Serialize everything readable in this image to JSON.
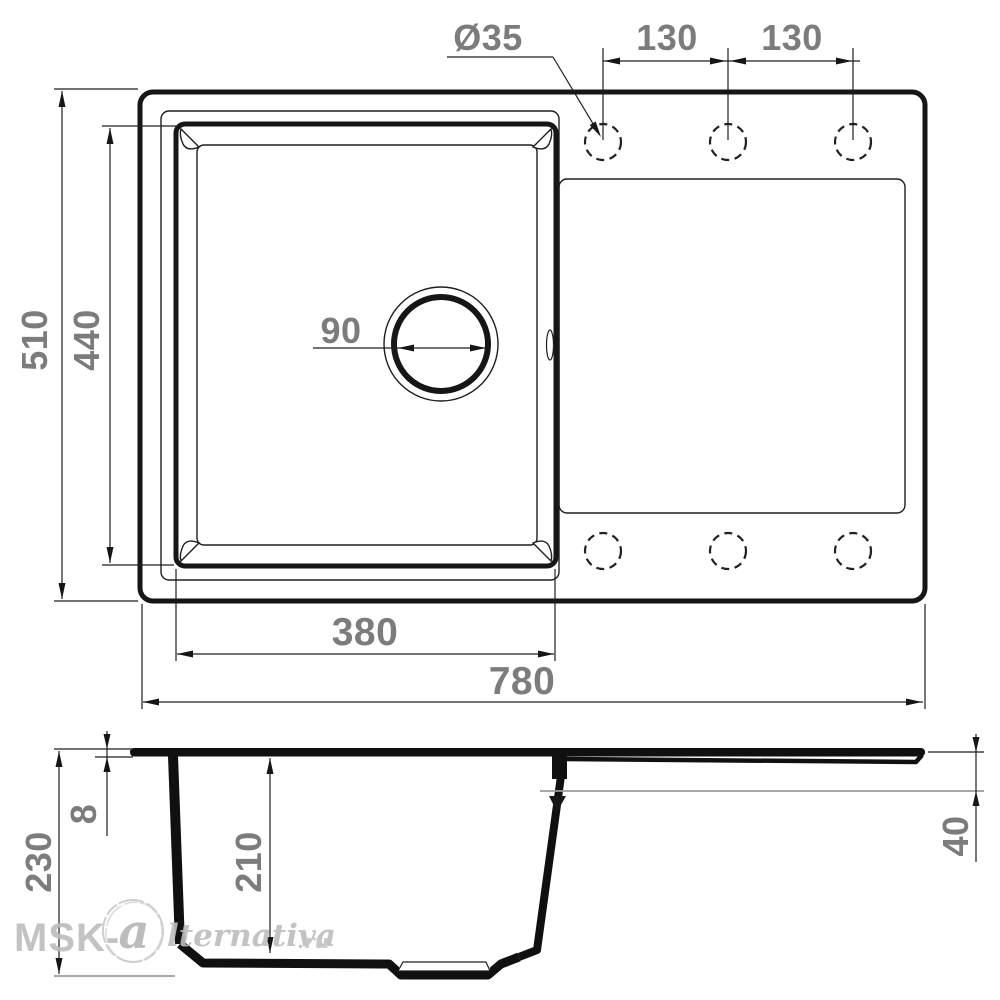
{
  "drawing_title": "sink-dimension-drawing",
  "top_view": {
    "labels": {
      "hole_diameter": "Ø35",
      "hole_pitch_left": "130",
      "hole_pitch_right": "130",
      "overall_depth": "510",
      "bowl_depth": "440",
      "drain_diameter": "90",
      "bowl_width": "380",
      "overall_width": "780"
    },
    "tap_hole_count": 6
  },
  "section_view": {
    "labels": {
      "overall_height": "230",
      "rim_thickness": "8",
      "bowl_inner_depth": "210",
      "deck_ledge_height": "40"
    }
  },
  "watermark": {
    "prefix": "MSK-",
    "initial": "a",
    "script": "lternativa",
    "tld": ".ru"
  }
}
